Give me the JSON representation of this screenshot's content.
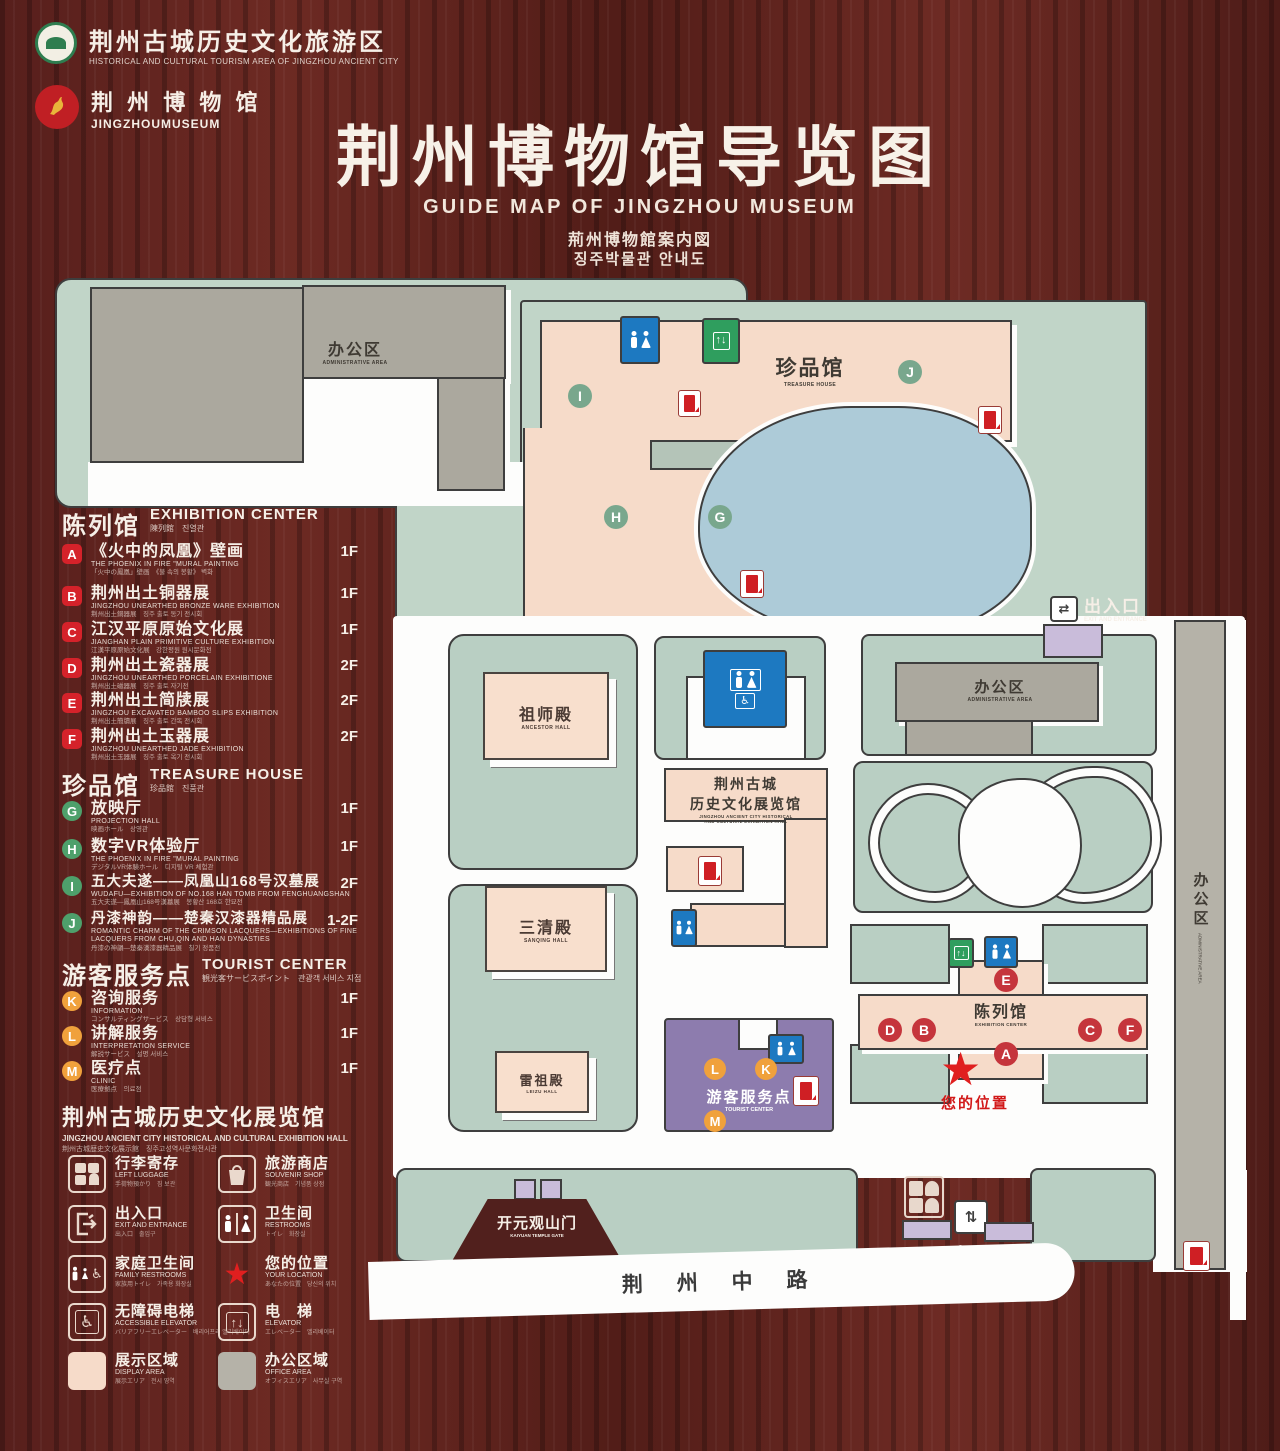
{
  "colors": {
    "wood": "#5a211d",
    "map_green": "#b9cfc3",
    "display_pink": "#f6dbc9",
    "office_gray": "#aba89e",
    "pond_blue": "#adcbd8",
    "tourist_purple": "#8d7cae",
    "badge_red": "#d5222a",
    "badge_green": "#4ea06b",
    "badge_orange": "#f0a13c",
    "star_red": "#e01f1f",
    "restroom_blue": "#1d79c1",
    "elevator_green": "#2f9e5e"
  },
  "header": {
    "logo1": {
      "cn": "荆州古城历史文化旅游区",
      "en": "HISTORICAL AND CULTURAL TOURISM AREA OF JINGZHOU ANCIENT CITY"
    },
    "logo2": {
      "cn": "荆 州 博 物 馆",
      "en": "JINGZHOUMUSEUM"
    },
    "title_cn": "荆州博物馆导览图",
    "title_en": "GUIDE MAP OF JINGZHOU MUSEUM",
    "title_jp": "荊州博物館案内図",
    "title_kr": "징주박물관 안내도"
  },
  "legend": {
    "exhibition": {
      "cn": "陈列馆",
      "en": "EXHIBITION CENTER",
      "sub": "陳列館　진열관",
      "items": [
        {
          "id": "A",
          "cn": "《火中的凤凰》壁画",
          "en": "THE PHOENIX IN FIRE \"MURAL PAINTING",
          "sub": "「火中の鳳凰」壁画　《불 속의 봉황》 벽화",
          "floor": "1F"
        },
        {
          "id": "B",
          "cn": "荆州出土铜器展",
          "en": "JINGZHOU UNEARTHED BRONZE WARE EXHIBITION",
          "sub": "荆州出土銅器展　징주 출토 동기 전시회",
          "floor": "1F"
        },
        {
          "id": "C",
          "cn": "江汉平原原始文化展",
          "en": "JIANGHAN PLAIN PRIMITIVE CULTURE EXHIBITION",
          "sub": "江漢平原原始文化展　강한평원 원시문화전",
          "floor": "1F"
        },
        {
          "id": "D",
          "cn": "荆州出土瓷器展",
          "en": "JINGZHOU UNEARTHED PORCELAIN EXHIBITIONE",
          "sub": "荆州出土磁器展　징주 출토 자기전",
          "floor": "2F"
        },
        {
          "id": "E",
          "cn": "荆州出土简牍展",
          "en": "JINGZHOU EXCAVATED BAMBOO SLIPS EXHIBITION",
          "sub": "荆州出土簡牘展　징주 출토 간독 전시회",
          "floor": "2F"
        },
        {
          "id": "F",
          "cn": "荆州出土玉器展",
          "en": "JINGZHOU UNEARTHED JADE EXHIBITION",
          "sub": "荆州出土玉器展　징주 출토 옥기 전시회",
          "floor": "2F"
        }
      ]
    },
    "treasure": {
      "cn": "珍品馆",
      "en": "TREASURE HOUSE",
      "sub": "珍品館　진품관",
      "items": [
        {
          "id": "G",
          "cn": "放映厅",
          "en": "PROJECTION HALL",
          "sub": "映画ホール　상영관",
          "floor": "1F"
        },
        {
          "id": "H",
          "cn": "数字VR体验厅",
          "en": "THE PHOENIX IN FIRE \"MURAL PAINTING",
          "sub": "デジタルVR体験ホール　디지털 VR 체험관",
          "floor": "1F"
        },
        {
          "id": "I",
          "cn": "五大夫遂——凤凰山168号汉墓展",
          "en": "WUDAFU—EXHIBITION OF NO.168 HAN TOMB FROM FENGHUANGSHAN",
          "sub": "五大夫遂—鳳凰山168号漢墓展　봉황산 168호 한묘전",
          "floor": "2F"
        },
        {
          "id": "J",
          "cn": "丹漆神韵——楚秦汉漆器精品展",
          "en": "ROMANTIC CHARM OF THE CRIMSON LACQUERS—EXHIBITIONS OF FINE LACQUERS FROM CHU,QIN AND HAN DYNASTIES",
          "sub": "丹漆の神韻—楚秦漢漆器精品展　칠기 정품전",
          "floor": "1-2F"
        }
      ]
    },
    "tourist": {
      "cn": "游客服务点",
      "en": "TOURIST CENTER",
      "sub": "観光客サービスポイント　관광객 서비스 지점",
      "items": [
        {
          "id": "K",
          "cn": "咨询服务",
          "en": "INFORMATION",
          "sub": "コンサルティングサービス　상담형 서비스",
          "floor": "1F"
        },
        {
          "id": "L",
          "cn": "讲解服务",
          "en": "INTERPRETATION SERVICE",
          "sub": "解説サービス　설명 서비스",
          "floor": "1F"
        },
        {
          "id": "M",
          "cn": "医疗点",
          "en": "CLINIC",
          "sub": "医療拠点　의료점",
          "floor": "1F"
        }
      ]
    },
    "hall_banner": {
      "cn": "荆州古城历史文化展览馆",
      "en": "JINGZHOU ANCIENT CITY HISTORICAL AND CULTURAL EXHIBITION HALL",
      "sub": "荆州古城歴史文化展示館　징주고성역사문화전시관"
    },
    "icons": [
      {
        "cn": "行李寄存",
        "en": "LEFT LUGGAGE",
        "sub": "手荷物預かり　짐 보관"
      },
      {
        "cn": "旅游商店",
        "en": "SOUVENIR SHOP",
        "sub": "観光商店　기념품 상점"
      },
      {
        "cn": "出入口",
        "en": "EXIT AND ENTRANCE",
        "sub": "出入口　출입구"
      },
      {
        "cn": "卫生间",
        "en": "RESTROOMS",
        "sub": "トイレ　화장실"
      },
      {
        "cn": "家庭卫生间",
        "en": "FAMILY RESTROOMS",
        "sub": "家族用トイレ　가족용 화장실"
      },
      {
        "cn": "您的位置",
        "en": "YOUR LOCATION",
        "sub": "あなたの位置　당신의 위치"
      },
      {
        "cn": "无障碍电梯",
        "en": "ACCESSIBLE ELEVATOR",
        "sub": "バリアフリーエレベーター　배리어프리 엘리베이터"
      },
      {
        "cn": "电　梯",
        "en": "ELEVATOR",
        "sub": "エレベーター　엘리베이터"
      },
      {
        "cn": "展示区域",
        "en": "DISPLAY AREA",
        "sub": "展示エリア　전시 영역"
      },
      {
        "cn": "办公区域",
        "en": "OFFICE AREA",
        "sub": "オフィスエリア　사무실 구역"
      }
    ]
  },
  "map": {
    "admin_top": {
      "cn": "办公区",
      "en": "ADMINISTRATIVE AREA"
    },
    "treasure": {
      "cn": "珍品馆",
      "en": "TREASURE HOUSE"
    },
    "ancestor": {
      "cn": "祖师殿",
      "en": "ANCESTOR HALL"
    },
    "sanqing": {
      "cn": "三清殿",
      "en": "SANQING HALL"
    },
    "leizu": {
      "cn": "雷祖殿",
      "en": "LEIZU HALL"
    },
    "hall_center_cn1": "荆州古城",
    "hall_center_cn2": "历史文化展览馆",
    "hall_center_en1": "JINGZHOU ANCIENT CITY HISTORICAL",
    "hall_center_en2": "AND CULTURAL EXHIBITION HALL",
    "admin_right": {
      "cn": "办公区",
      "en": "ADMINISTRATIVE AREA"
    },
    "admin_strip": {
      "cn": "办公区",
      "en": "ADMINISTRATIVE AREA"
    },
    "exh_center": {
      "cn": "陈列馆",
      "en": "EXHIBITION CENTER"
    },
    "tourist": {
      "cn": "游客服务点",
      "en": "TOURIST CENTER"
    },
    "your_location": "您的位置",
    "gate": {
      "cn": "开元观山门",
      "en": "KAIYUAN TEMPLE GATE"
    },
    "exit_top": {
      "cn": "出入口",
      "en": "EXIT AND ENTRANCE"
    },
    "exit_bottom": {
      "cn": "出入口",
      "en": "EXIT AND ENTRANCE"
    },
    "road": "荆 州 中 路",
    "star": "★",
    "markers": {
      "I": "I",
      "J": "J",
      "H": "H",
      "G": "G",
      "A": "A",
      "B": "B",
      "C": "C",
      "D": "D",
      "E": "E",
      "F": "F",
      "K": "K",
      "L": "L",
      "M": "M"
    }
  }
}
